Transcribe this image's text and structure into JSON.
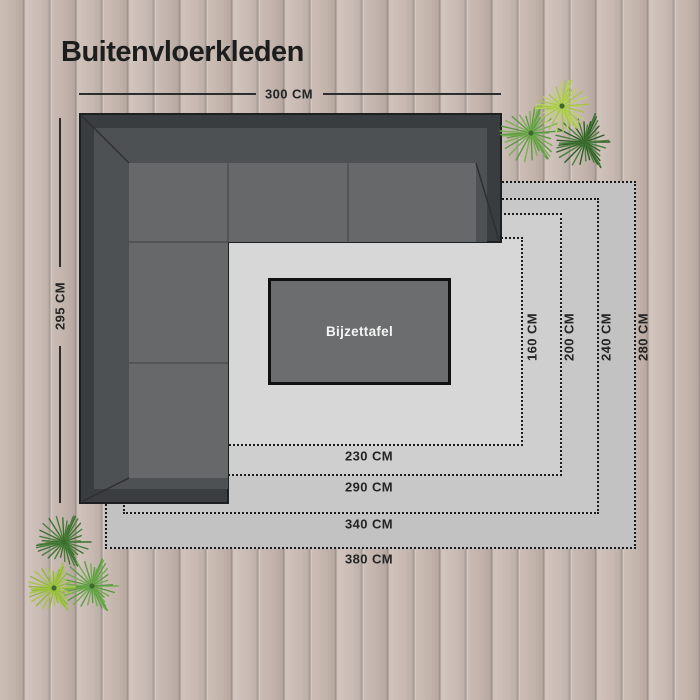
{
  "title": "Buitenvloerkleden",
  "sofa": {
    "type": "corner-lounge-set",
    "width_label": "300 CM",
    "height_label": "295 CM"
  },
  "table": {
    "label": "Bijzettafel"
  },
  "rugs": [
    {
      "width_label": "380 CM",
      "height_label": "280 CM",
      "color": "#c2c2c3"
    },
    {
      "width_label": "340 CM",
      "height_label": "240 CM",
      "color": "#c8c8c9"
    },
    {
      "width_label": "290 CM",
      "height_label": "200 CM",
      "color": "#cfcfd0"
    },
    {
      "width_label": "230 CM",
      "height_label": "160 CM",
      "color": "#d7d7d7"
    }
  ],
  "colors": {
    "wood": "#cabcb4",
    "sofa_frame": "#3a3d3f",
    "sofa_backrest": "#4e5153",
    "sofa_seat": "#66686a",
    "table_fill": "#6b6d6e",
    "dotted_border": "#1b1b1b",
    "dimension_line": "#2b2d2e",
    "text": "#242424",
    "plant_bright": "#a6c647",
    "plant_mid": "#5d9a43",
    "plant_dark": "#47803a"
  }
}
